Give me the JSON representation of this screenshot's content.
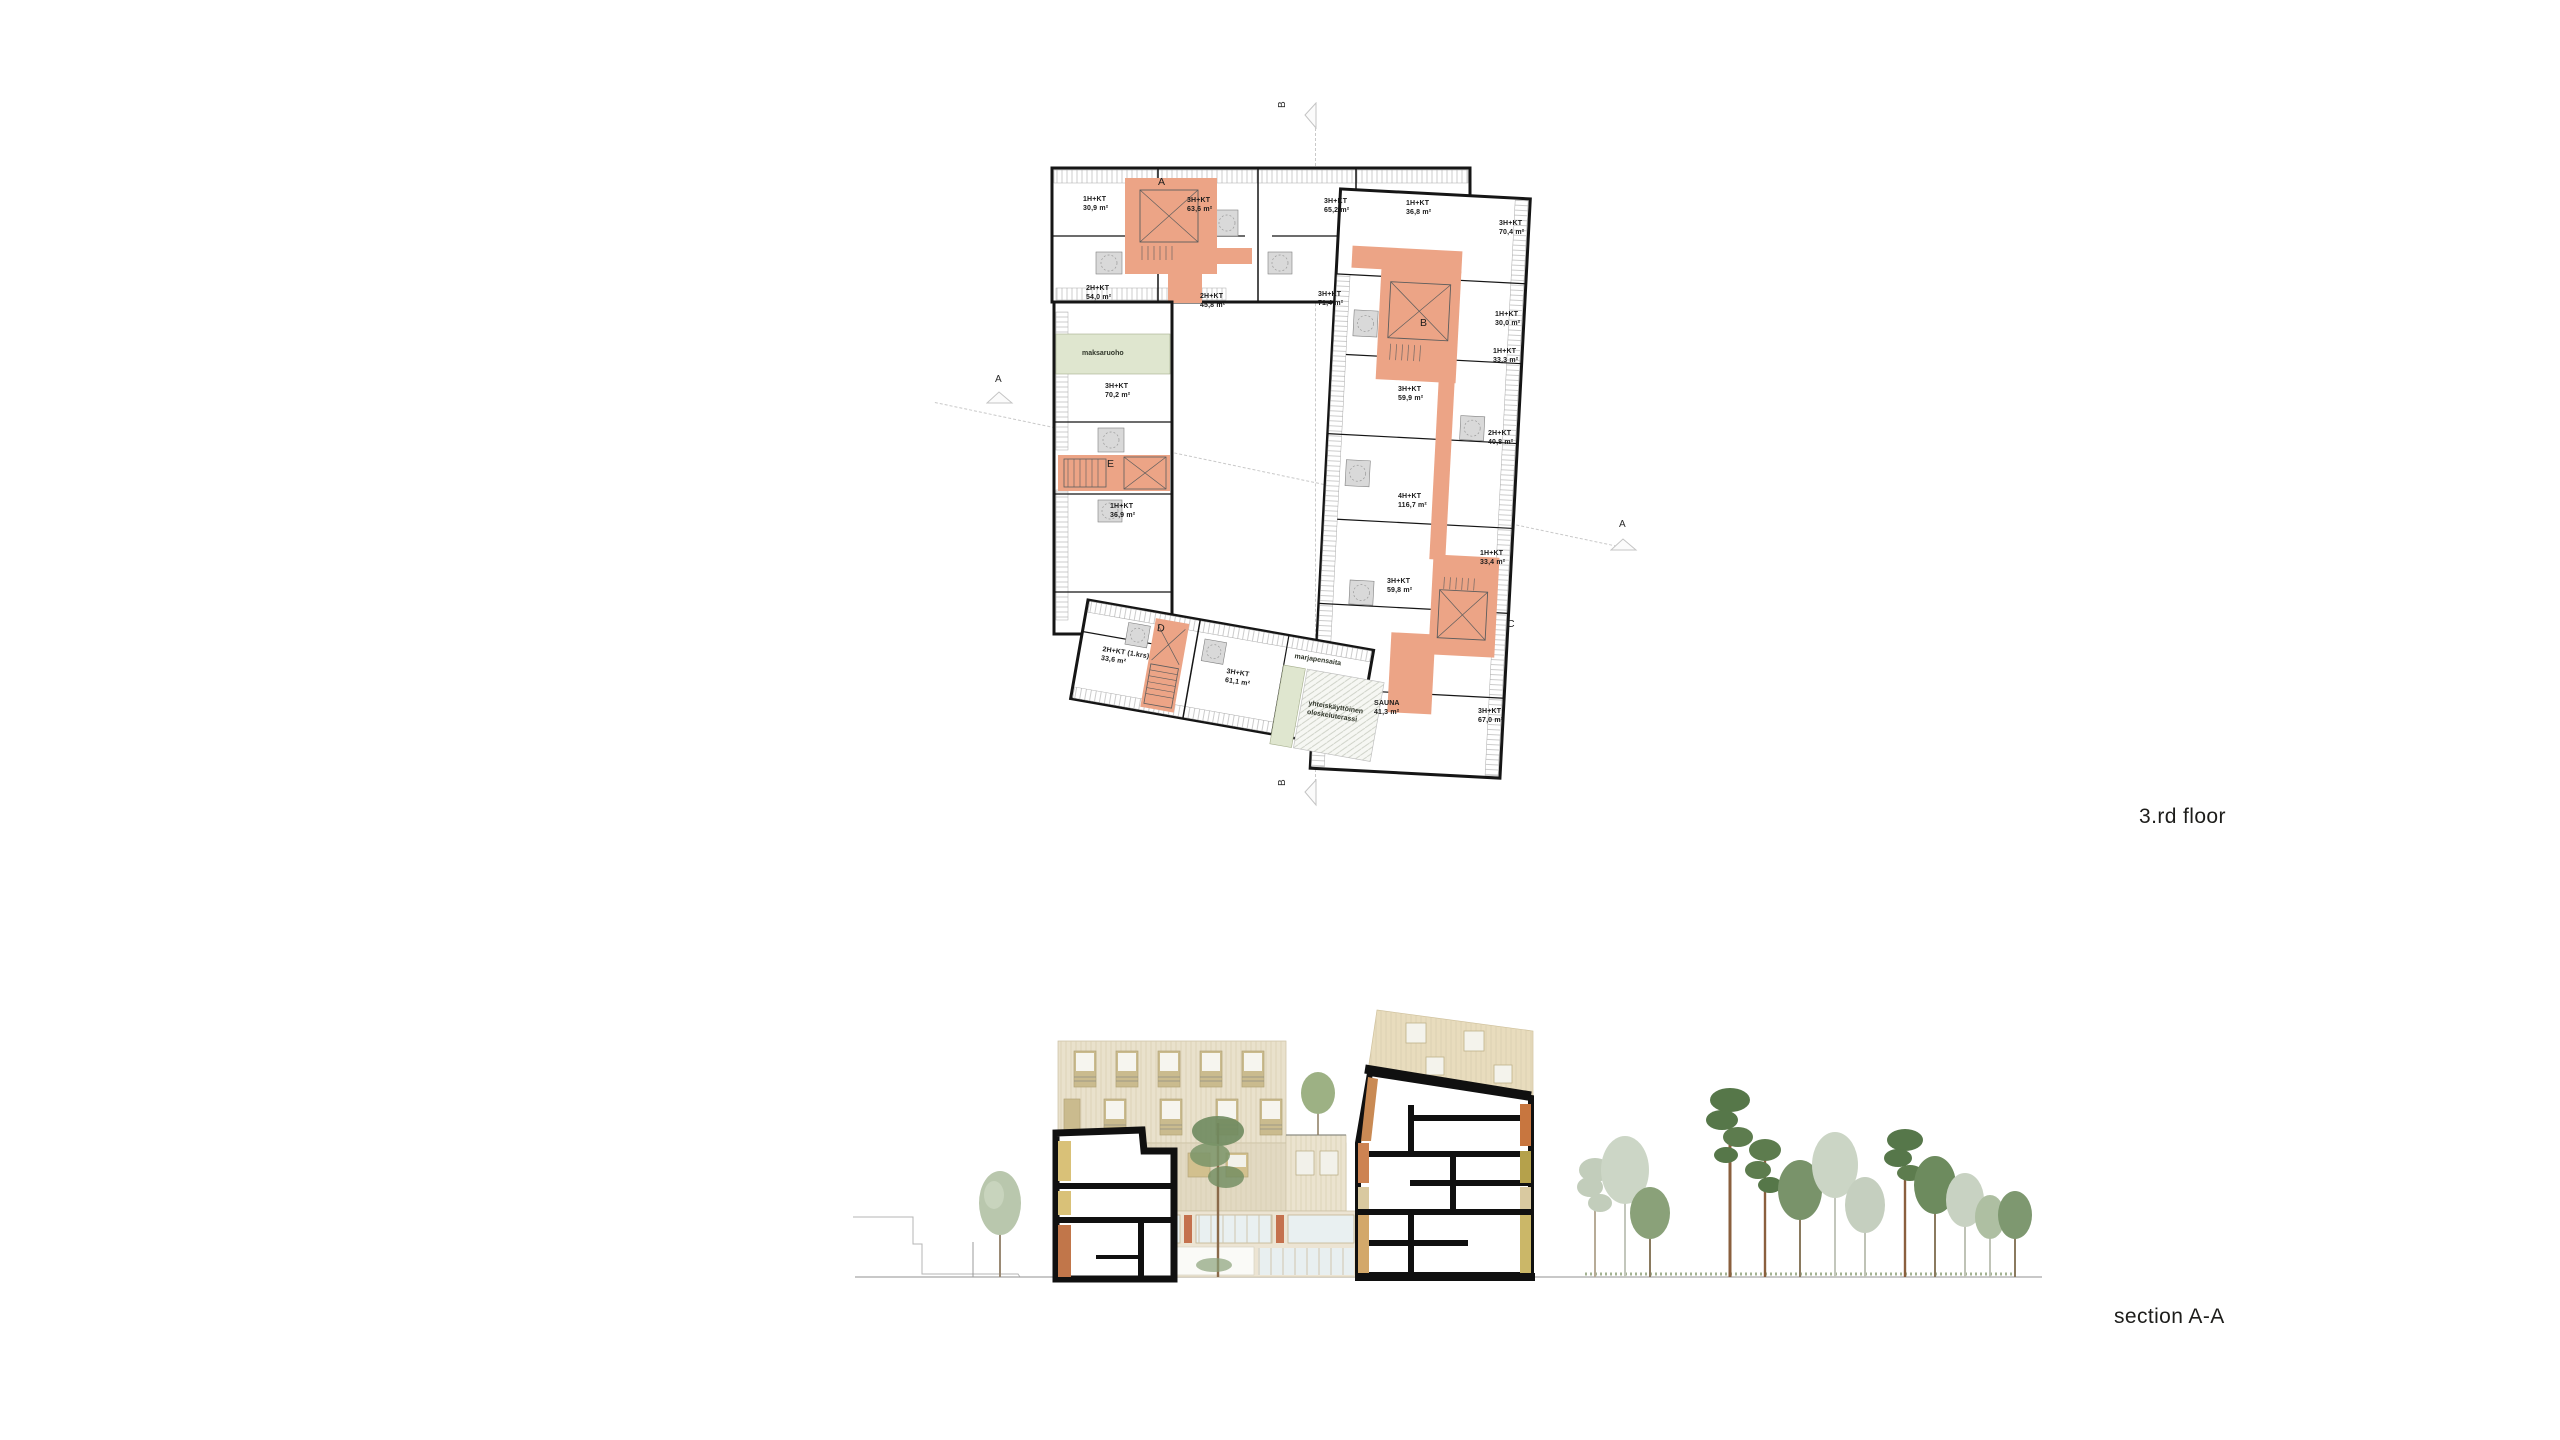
{
  "titles": {
    "floor_plan": "3.rd floor",
    "section": "section A-A"
  },
  "plan": {
    "colors": {
      "stair_core": "#eca486",
      "green_area": "#dfe6cf",
      "wet_room": "#d9d9d9",
      "walls": "#151515",
      "hatch": "#bdbdbd",
      "section_line": "#c9c9c9"
    },
    "labels": [
      {
        "name": "unit-1hkt-309",
        "cls": "unit",
        "text": "1H+KT\n30,9 m²",
        "x": 1083,
        "y": 196
      },
      {
        "name": "unit-3hkt-636",
        "cls": "unit",
        "text": "3H+KT\n63,6 m²",
        "x": 1187,
        "y": 197
      },
      {
        "name": "unit-2hkt-540",
        "cls": "unit",
        "text": "2H+KT\n54,0 m²",
        "x": 1086,
        "y": 285
      },
      {
        "name": "unit-2hkt-458",
        "cls": "unit",
        "text": "2H+KT\n45,8 m²",
        "x": 1200,
        "y": 293
      },
      {
        "name": "unit-3hkt-652",
        "cls": "unit",
        "text": "3H+KT\n65,2 m²",
        "x": 1324,
        "y": 198
      },
      {
        "name": "unit-1hkt-368",
        "cls": "unit",
        "text": "1H+KT\n36,8 m²",
        "x": 1406,
        "y": 200
      },
      {
        "name": "unit-3hkt-714",
        "cls": "unit",
        "text": "3H+KT\n71,4 m²",
        "x": 1318,
        "y": 291
      },
      {
        "name": "unit-3hkt-704",
        "cls": "unit",
        "text": "3H+KT\n70,4 m²",
        "x": 1499,
        "y": 220
      },
      {
        "name": "unit-1hkt-300",
        "cls": "unit",
        "text": "1H+KT\n30,0 m²",
        "x": 1495,
        "y": 311
      },
      {
        "name": "unit-1hkt-333",
        "cls": "unit",
        "text": "1H+KT\n33,3 m²",
        "x": 1493,
        "y": 348
      },
      {
        "name": "unit-3hkt-599",
        "cls": "unit",
        "text": "3H+KT\n59,9 m²",
        "x": 1398,
        "y": 386
      },
      {
        "name": "unit-2hkt-408",
        "cls": "unit",
        "text": "2H+KT\n40,8 m²",
        "x": 1488,
        "y": 430
      },
      {
        "name": "unit-4hkt-1167",
        "cls": "unit",
        "text": "4H+KT\n116,7 m²",
        "x": 1398,
        "y": 493
      },
      {
        "name": "unit-1hkt-334",
        "cls": "unit",
        "text": "1H+KT\n33,4 m²",
        "x": 1480,
        "y": 550
      },
      {
        "name": "unit-3hkt-598",
        "cls": "unit",
        "text": "3H+KT\n59,8 m²",
        "x": 1387,
        "y": 578
      },
      {
        "name": "room-sauna",
        "cls": "unit",
        "text": "SAUNA\n41,3 m²",
        "x": 1374,
        "y": 700
      },
      {
        "name": "unit-3hkt-670",
        "cls": "unit",
        "text": "3H+KT\n67,0 m²",
        "x": 1478,
        "y": 708
      },
      {
        "name": "unit-3hkt-702",
        "cls": "unit",
        "text": "3H+KT\n70,2 m²",
        "x": 1105,
        "y": 383
      },
      {
        "name": "unit-1hkt-369",
        "cls": "unit",
        "text": "1H+KT\n36,9 m²",
        "x": 1110,
        "y": 503
      },
      {
        "name": "unit-2hkt-336-1krs",
        "cls": "unit",
        "text": "2H+KT (1.krs)\n33,6 m²",
        "x": 1103,
        "y": 646,
        "rot": 9
      },
      {
        "name": "unit-3hkt-611",
        "cls": "unit",
        "text": "3H+KT\n61,1 m²",
        "x": 1227,
        "y": 668,
        "rot": 9
      },
      {
        "name": "area-maksaruoho",
        "cls": "green",
        "text": "maksaruoho",
        "x": 1082,
        "y": 350
      },
      {
        "name": "area-marjapensaita",
        "cls": "green",
        "text": "marjapensaita",
        "x": 1295,
        "y": 653,
        "rot": 9
      },
      {
        "name": "area-shared-terrace",
        "cls": "green",
        "text": "yhteiskäyttöinen\noleskeluterassi",
        "x": 1309,
        "y": 700,
        "rot": 9
      },
      {
        "name": "stair-a-label",
        "cls": "stair",
        "text": "A",
        "x": 1158,
        "y": 176
      },
      {
        "name": "stair-b-label",
        "cls": "stair",
        "text": "B",
        "x": 1420,
        "y": 317
      },
      {
        "name": "stair-c-label",
        "cls": "stair",
        "text": "C",
        "x": 1507,
        "y": 618
      },
      {
        "name": "stair-d-label",
        "cls": "stair",
        "text": "D",
        "x": 1158,
        "y": 622,
        "rot": 9
      },
      {
        "name": "stair-e-label",
        "cls": "stair",
        "text": "E",
        "x": 1107,
        "y": 458
      }
    ],
    "markers": [
      {
        "name": "section-marker-a-left",
        "cls": "marker",
        "text": "A",
        "x": 995,
        "y": 374
      },
      {
        "name": "section-marker-a-right",
        "cls": "marker",
        "text": "A",
        "x": 1619,
        "y": 519
      },
      {
        "name": "section-marker-b-top",
        "cls": "marker",
        "text": "B",
        "x": 1277,
        "y": 108,
        "rot": -90
      },
      {
        "name": "section-marker-b-bottom",
        "cls": "marker",
        "text": "B",
        "x": 1277,
        "y": 786,
        "rot": -90
      }
    ]
  }
}
